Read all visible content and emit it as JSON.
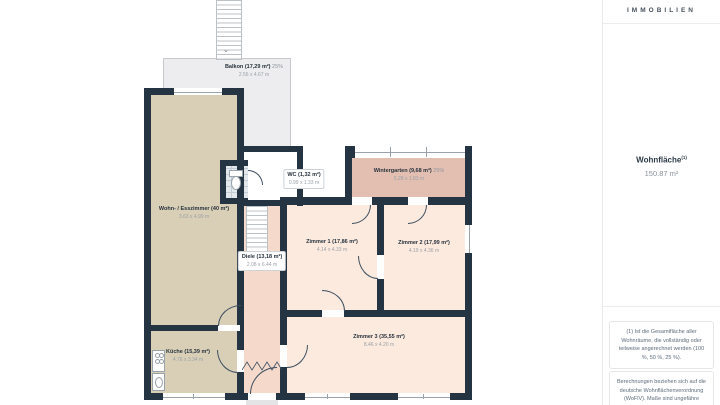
{
  "plan": {
    "rooms": {
      "balkon": {
        "name": "Balkon (17,29 m²)",
        "pct": "25%",
        "dims": "2.56 x 4.67 m"
      },
      "wintergarten": {
        "name": "Wintergarten (9,68 m²)",
        "pct": "25%",
        "dims": "5.28 x 1.83 m"
      },
      "wc": {
        "name": "WC (1,32 m²)",
        "dims": "0.99 x 1.33 m"
      },
      "wohn_esszimmer": {
        "name": "Wohn- / Esszimmer (40 m²)",
        "dims": "3.63 x 4.99 m"
      },
      "diele": {
        "name": "Diele (13,18 m²)",
        "dims": "2.08 x 6.44 m"
      },
      "zimmer1": {
        "name": "Zimmer 1 (17,86 m²)",
        "dims": "4.14 x 4.33 m"
      },
      "zimmer2": {
        "name": "Zimmer 2 (17,99 m²)",
        "dims": "4.19 x 4.36 m"
      },
      "zimmer3": {
        "name": "Zimmer 3 (35,55 m²)",
        "dims": "8.46 x 4.20 m"
      },
      "kueche": {
        "name": "Küche (15,39 m²)",
        "dims": "4.76 x 3.34 m"
      }
    },
    "colors": {
      "wall": "#243443",
      "living_beige": "#d9cfb6",
      "bedroom_pink": "#fdeade",
      "hallway_pink": "#f5d9cb",
      "wintergarten_rose": "#e3bfb1",
      "balcony_gray": "#ededef",
      "wc_tile": "#e3e8ec"
    }
  },
  "sidebar": {
    "brand": "IMMOBILIEN",
    "area_label": "Wohnfläche",
    "area_sup": "(1)",
    "area_value": "150.87 m²",
    "note_calculation": "(1) Ist die Gesamtfläche aller Wohnräume, die vollständig oder teilweise angerechnet werden (100 %, 50 %, 25 %).",
    "note_disclaimer": "Berechnungen beziehen sich auf die deutsche Wohnflächenverordnung (WoFlV). Maße sind ungefähre Angaben"
  }
}
